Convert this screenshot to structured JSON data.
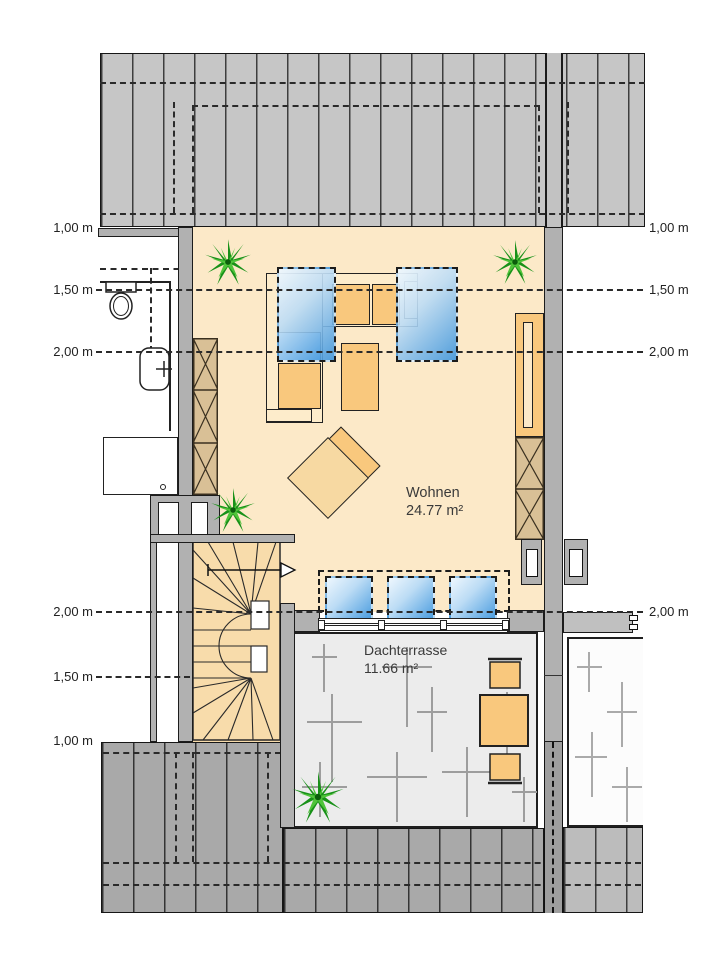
{
  "plan": {
    "title": "Dachgeschoss Grundriss",
    "rooms": [
      {
        "id": "wohnen",
        "name": "Wohnen",
        "area": "24.77 m²"
      },
      {
        "id": "dachterrasse",
        "name": "Dachterrasse",
        "area": "11.66 m²"
      }
    ],
    "height_labels_left": [
      "1,00 m",
      "1,50 m",
      "2,00 m",
      "2,00 m",
      "1,50 m",
      "1,00 m"
    ],
    "height_labels_right": [
      "1,00 m",
      "1,50 m",
      "2,00 m",
      "2,00 m"
    ]
  },
  "icons": {
    "plant": "plant-starburst",
    "toilet": "toilet-top-view",
    "washbasin": "washbasin-top-view",
    "stair_arrow": "stair-direction-arrow"
  },
  "colors": {
    "floor": "#fce9c8",
    "furniture_orange": "#f9c87d",
    "wardrobe_tan": "#d9c096",
    "glass_blue": "#3f96dd",
    "wall_gray": "#b1b1b1",
    "roof_top_gray": "#c6c6c6",
    "roof_bottom_gray": "#a9a9a9",
    "terrace_gray": "#ececec",
    "plant_green": "#1f9e1f"
  }
}
